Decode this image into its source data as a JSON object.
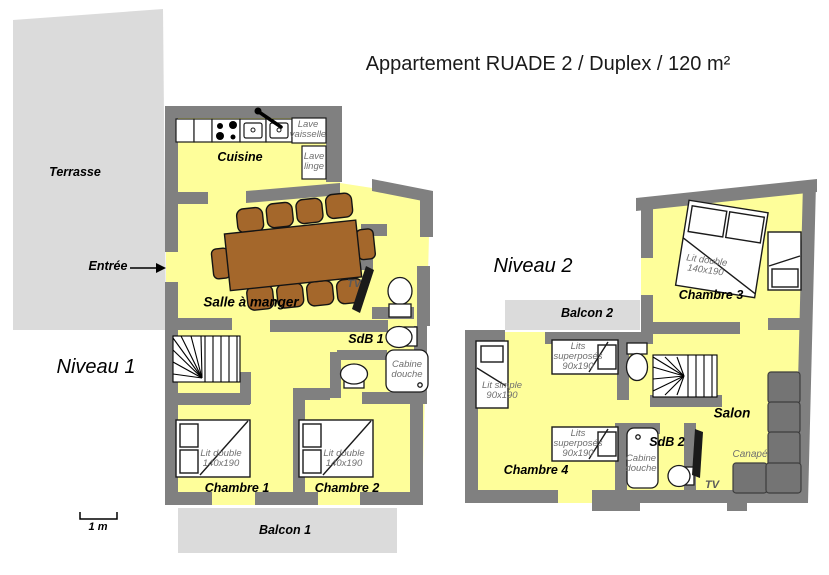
{
  "title": "Appartement RUADE 2 / Duplex / 120 m²",
  "scale": {
    "label": "1 m"
  },
  "colors": {
    "floor": "#FEFE9A",
    "wall": "#808080",
    "outdoor": "#DBDBDB",
    "wood": "#A4672B",
    "sofa": "#747474",
    "fixture_outline": "#1a1a1a",
    "furniture_label": "#6f6f6f"
  },
  "level1": {
    "label": "Niveau 1",
    "entree": "Entrée",
    "outdoor": {
      "terrasse": "Terrasse",
      "balcon": "Balcon 1"
    },
    "rooms": {
      "cuisine": "Cuisine",
      "salle_a_manger": "Salle à manger",
      "sdb": "SdB 1",
      "chambre1": "Chambre 1",
      "chambre2": "Chambre 2"
    },
    "fixtures": {
      "lave_vaisselle": "Lave\nvaisselle",
      "lave_linge": "Lave\nlinge",
      "tv": "TV",
      "cabine_douche": "Cabine\ndouche",
      "lit_double": "Lit double\n140x190"
    }
  },
  "level2": {
    "label": "Niveau 2",
    "outdoor": {
      "balcon": "Balcon 2"
    },
    "rooms": {
      "chambre3": "Chambre 3",
      "chambre4": "Chambre 4",
      "sdb": "SdB 2",
      "salon": "Salon"
    },
    "fixtures": {
      "lit_double": "Lit double\n140x190",
      "lit_simple": "Lit simple\n90x190",
      "lits_superposes": "Lits\nsuperposés\n90x190",
      "cabine_douche": "Cabine\ndouche",
      "tv": "TV",
      "canape": "Canapé"
    }
  }
}
